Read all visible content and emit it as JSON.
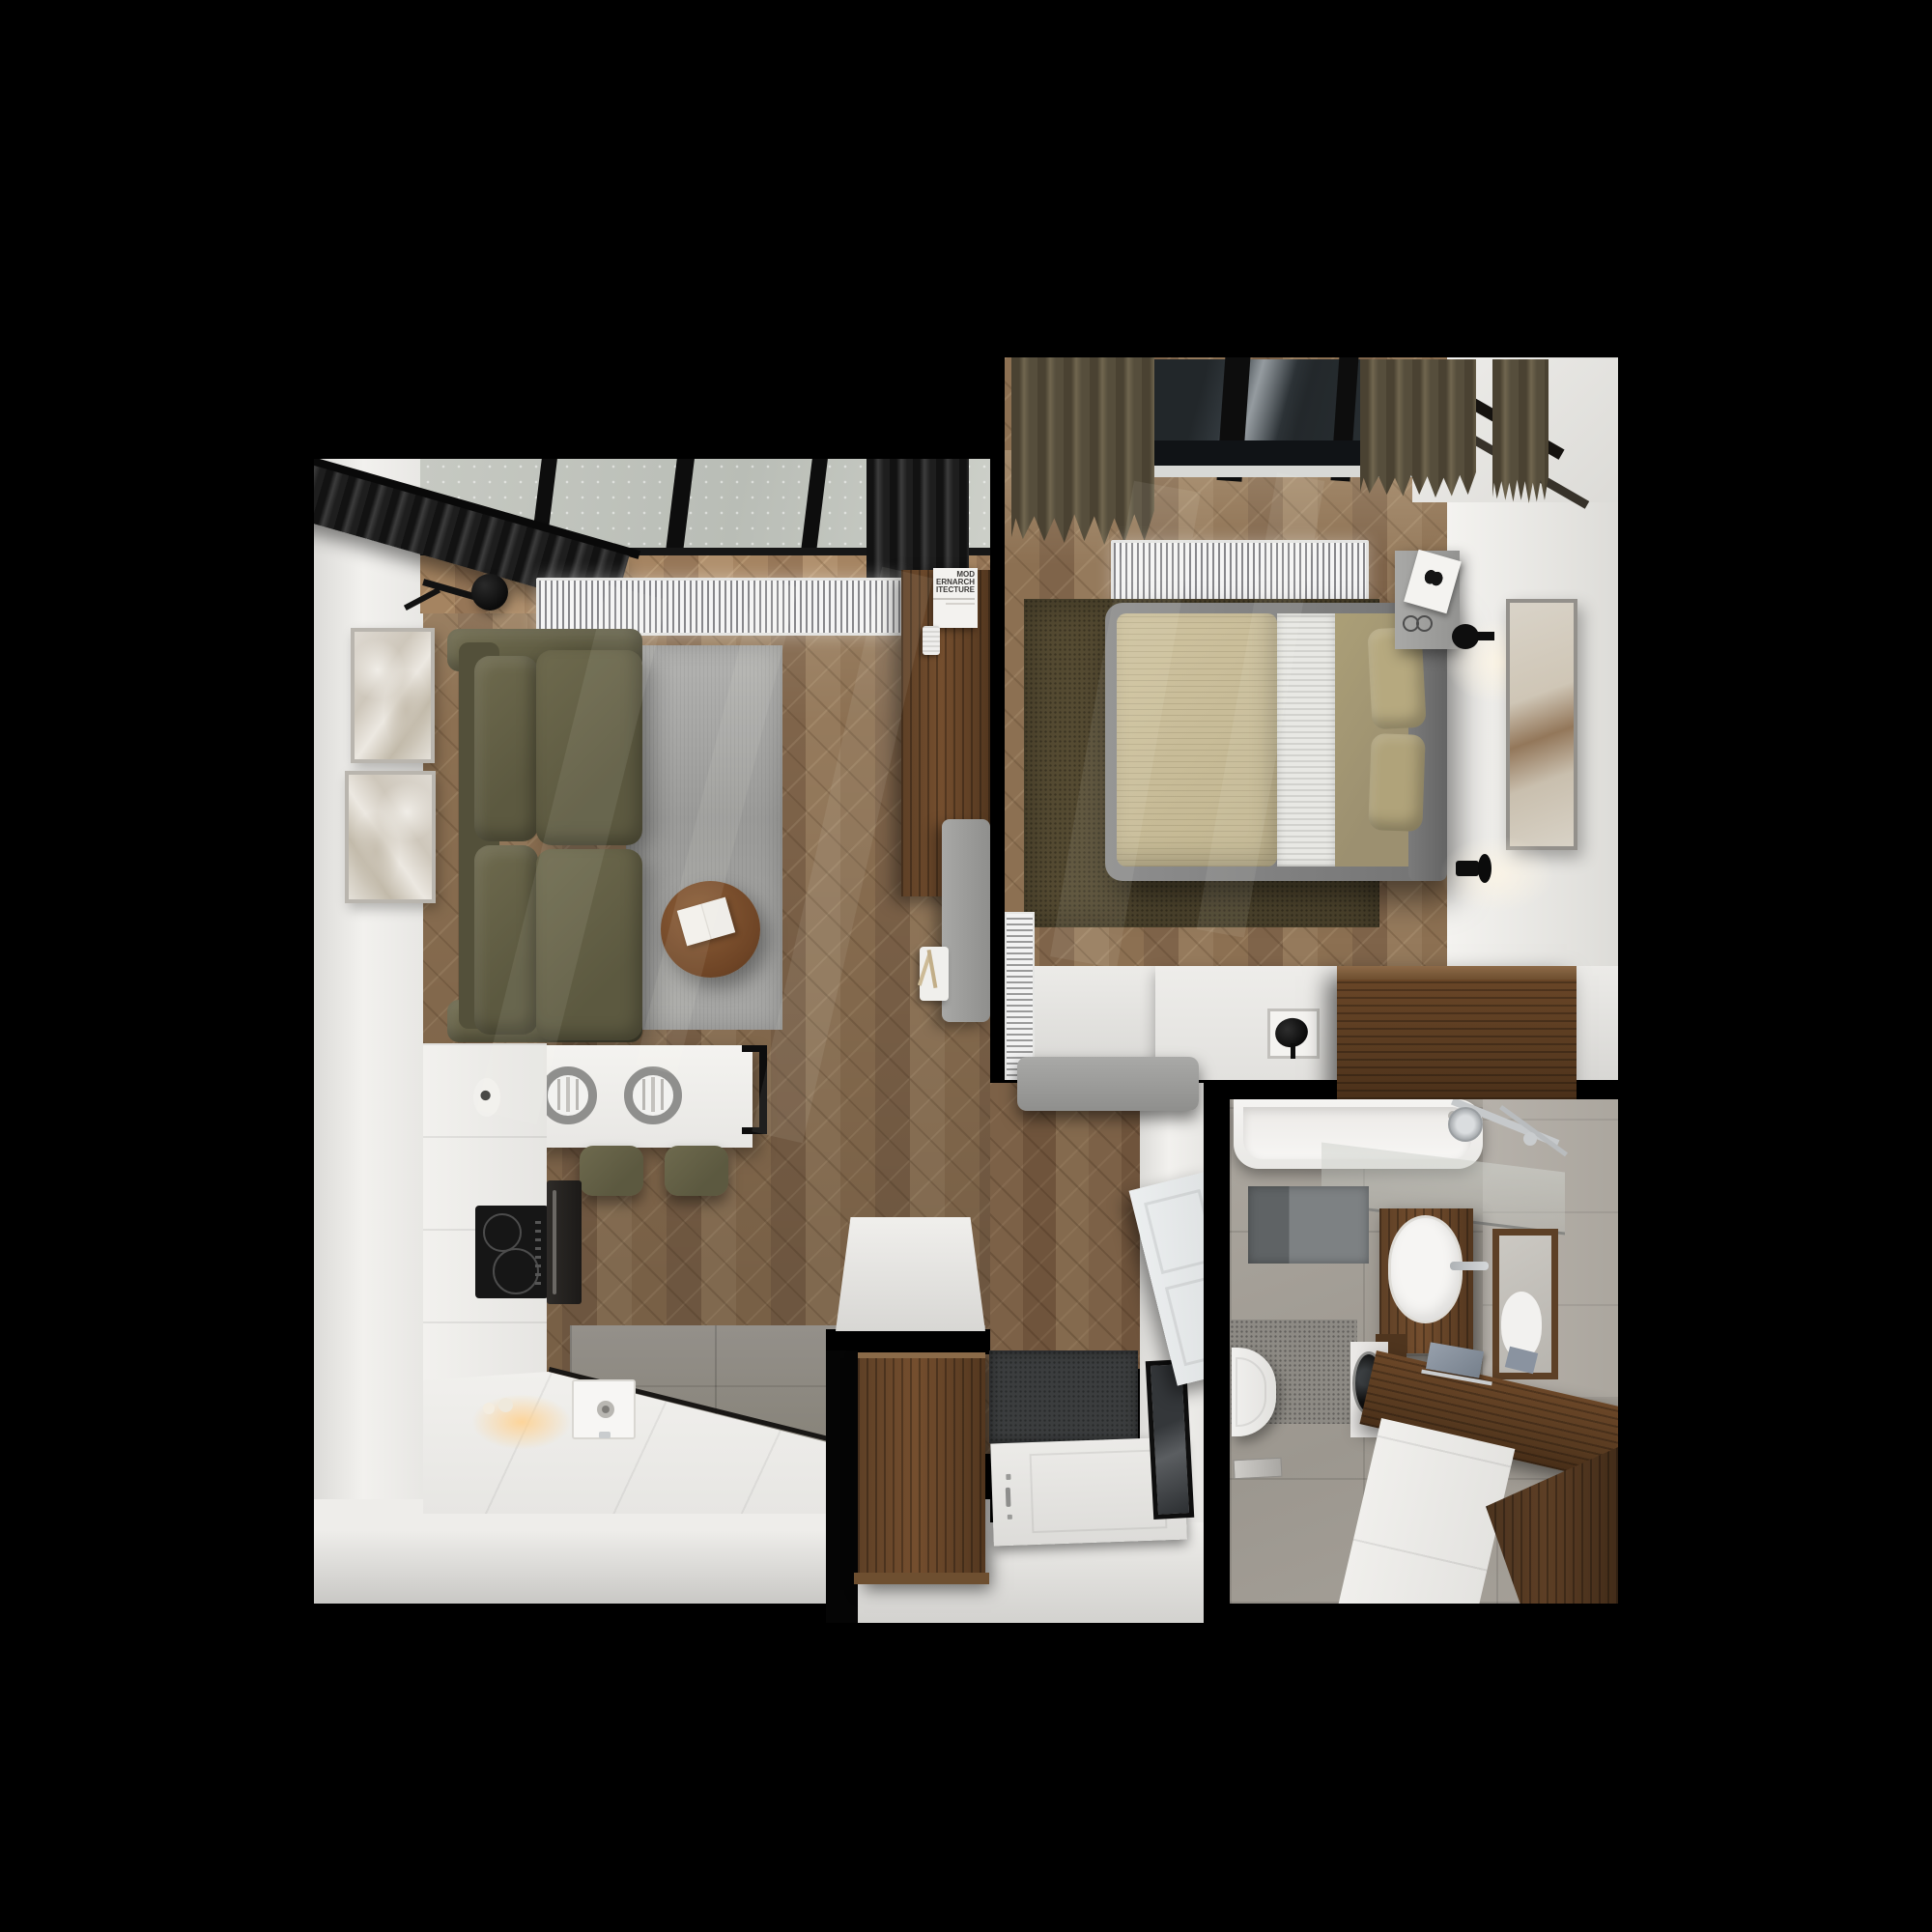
{
  "scene": {
    "type": "top-down-3d-apartment-render",
    "background": "#000000",
    "rooms_count": 4
  },
  "poster": {
    "line1": "MOD",
    "line2": "ERNARCH",
    "line3": "ITECTURE"
  },
  "rooms": {
    "living_kitchen": {
      "label": "living-room-with-kitchen",
      "floor": "oak-chevron-parquet",
      "items": [
        "skylight-window",
        "dark-gray-curtains",
        "white-radiator-grille",
        "black-wall-lamp",
        "framed-marble-artwork-top",
        "framed-marble-artwork-bottom",
        "olive-two-seat-sofa",
        "gray-area-rug",
        "round-walnut-coffee-table",
        "open-magazine",
        "walnut-sideboard",
        "architecture-poster",
        "white-wall-speaker",
        "gray-bench",
        "decor-tray-with-dried-flowers",
        "white-breakfast-bar",
        "two-place-settings",
        "black-bar-frame",
        "two-olive-bar-stools",
        "white-kitchen-cabinets",
        "induction-cooktop",
        "built-in-oven",
        "paper-towel-roll",
        "kitchen-sink",
        "under-cabinet-warm-light",
        "gray-tile-kitchen-floor",
        "white-console-table"
      ]
    },
    "bedroom": {
      "label": "bedroom",
      "floor": "oak-chevron-parquet",
      "items": [
        "skylight-window",
        "olive-curtains",
        "white-radiator-grille",
        "dark-olive-rug",
        "double-bed-gray-frame",
        "striped-beige-duvet",
        "white-runner-blanket",
        "khaki-sheet",
        "two-khaki-pillows",
        "gray-nightstand",
        "butterfly-magazine",
        "reading-glasses",
        "black-wall-lamp-upper",
        "black-wall-lamp-lower",
        "tall-framed-artwork",
        "white-panel-radiator",
        "white-desk",
        "silver-frame-recess",
        "black-desk-lamp",
        "walnut-dresser",
        "gray-bench"
      ]
    },
    "bathroom": {
      "label": "bathroom",
      "floor": "gray-stone-tile",
      "items": [
        "bathtub",
        "chrome-shower-set",
        "glass-shower-screen",
        "two-tone-gray-bath-mat",
        "walnut-washbasin-cabinet",
        "white-oval-vessel-sink",
        "chrome-faucet",
        "walnut-framed-mirror",
        "wall-hung-toilet",
        "washing-machine",
        "walnut-top-vanity-run",
        "white-vanity-drawers",
        "blue-gray-towel",
        "floor-drain-plate"
      ]
    },
    "hallway": {
      "label": "entry-hallway",
      "floor": "oak-chevron-parquet",
      "items": [
        "walnut-wardrobe",
        "dark-speckled-doormat",
        "white-interior-door-open",
        "white-entrance-door",
        "door-handle-and-lock",
        "black-framed-mirror"
      ]
    }
  },
  "palette": {
    "background": "#000000",
    "wood_floor": "#8a6f52",
    "walnut_furniture": "#5e4026",
    "olive_upholstery": "#67644a",
    "gray_rug": "#a0a09e",
    "wall_white": "#efeeec",
    "bedroom_rug": "#554b32",
    "bath_tile": "#a49f99",
    "curtain_dark": "#2b2b2b",
    "curtain_olive": "#675e49",
    "chrome": "#c9ccce"
  }
}
